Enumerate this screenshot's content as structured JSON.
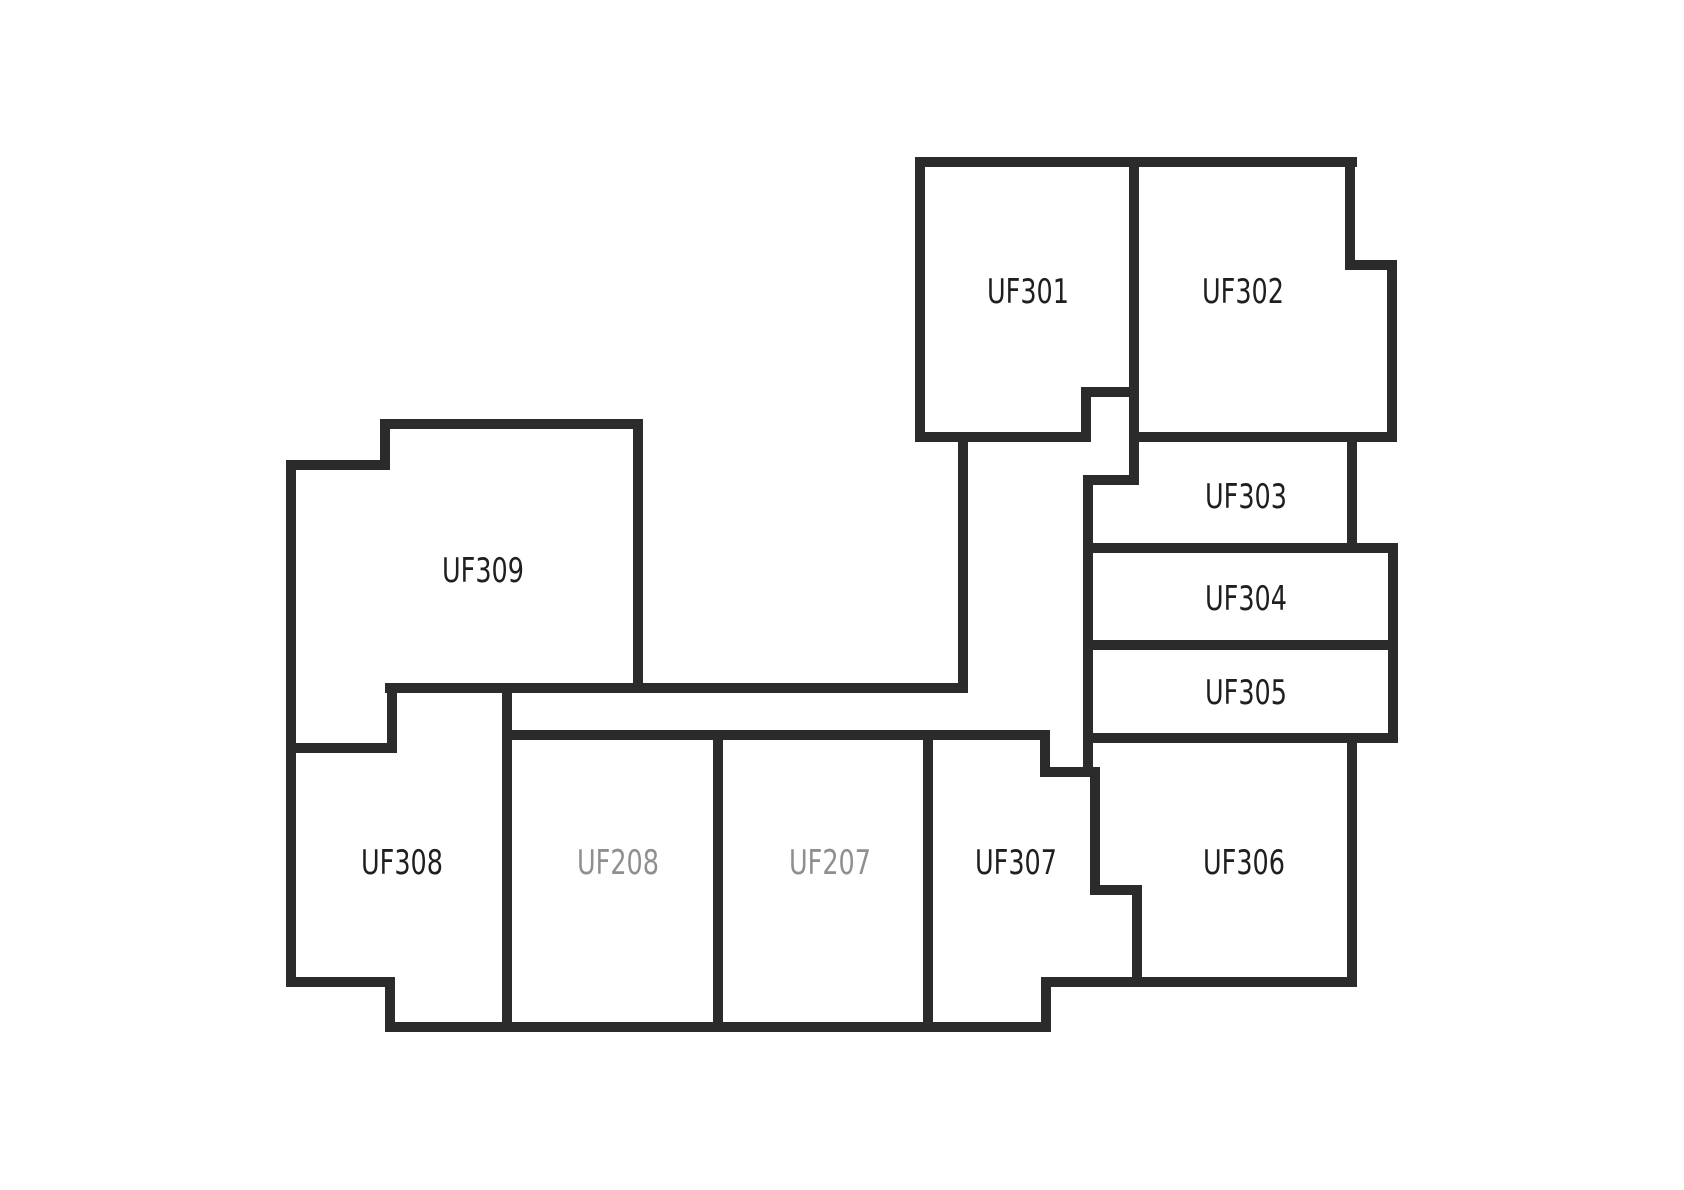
{
  "canvas": {
    "width": 1684,
    "height": 1190,
    "background": "#ffffff"
  },
  "style": {
    "wall_color": "#2b2b2b",
    "wall_thickness": 10,
    "label_color": "#1f1f1f",
    "label_color_muted": "#8f8f8f",
    "label_font_size": 34,
    "label_x_scale": 0.75
  },
  "floorplan": {
    "rooms": [
      {
        "id": "uf301",
        "label": "UF301",
        "muted": false,
        "label_x": 1028,
        "label_y": 291
      },
      {
        "id": "uf302",
        "label": "UF302",
        "muted": false,
        "label_x": 1243,
        "label_y": 291
      },
      {
        "id": "uf303",
        "label": "UF303",
        "muted": false,
        "label_x": 1246,
        "label_y": 496
      },
      {
        "id": "uf304",
        "label": "UF304",
        "muted": false,
        "label_x": 1246,
        "label_y": 598
      },
      {
        "id": "uf305",
        "label": "UF305",
        "muted": false,
        "label_x": 1246,
        "label_y": 692
      },
      {
        "id": "uf306",
        "label": "UF306",
        "muted": false,
        "label_x": 1244,
        "label_y": 862
      },
      {
        "id": "uf307",
        "label": "UF307",
        "muted": false,
        "label_x": 1016,
        "label_y": 862
      },
      {
        "id": "uf207",
        "label": "UF207",
        "muted": true,
        "label_x": 830,
        "label_y": 862
      },
      {
        "id": "uf208",
        "label": "UF208",
        "muted": true,
        "label_x": 618,
        "label_y": 862
      },
      {
        "id": "uf308",
        "label": "UF308",
        "muted": false,
        "label_x": 402,
        "label_y": 862
      },
      {
        "id": "uf309",
        "label": "UF309",
        "muted": false,
        "label_x": 483,
        "label_y": 570
      }
    ],
    "walls": [
      {
        "x1": 920,
        "y1": 162,
        "x2": 1352,
        "y2": 162
      },
      {
        "x1": 920,
        "y1": 162,
        "x2": 920,
        "y2": 437
      },
      {
        "x1": 920,
        "y1": 437,
        "x2": 1086,
        "y2": 437
      },
      {
        "x1": 1086,
        "y1": 392,
        "x2": 1086,
        "y2": 437
      },
      {
        "x1": 1086,
        "y1": 392,
        "x2": 1134,
        "y2": 392
      },
      {
        "x1": 1134,
        "y1": 162,
        "x2": 1134,
        "y2": 480
      },
      {
        "x1": 1350,
        "y1": 162,
        "x2": 1350,
        "y2": 265
      },
      {
        "x1": 1350,
        "y1": 265,
        "x2": 1392,
        "y2": 265
      },
      {
        "x1": 1392,
        "y1": 265,
        "x2": 1392,
        "y2": 437
      },
      {
        "x1": 1134,
        "y1": 437,
        "x2": 1392,
        "y2": 437
      },
      {
        "x1": 1088,
        "y1": 480,
        "x2": 1134,
        "y2": 480
      },
      {
        "x1": 1088,
        "y1": 480,
        "x2": 1088,
        "y2": 772
      },
      {
        "x1": 1352,
        "y1": 437,
        "x2": 1352,
        "y2": 548
      },
      {
        "x1": 1088,
        "y1": 548,
        "x2": 1393,
        "y2": 548
      },
      {
        "x1": 1088,
        "y1": 645,
        "x2": 1393,
        "y2": 645
      },
      {
        "x1": 1393,
        "y1": 548,
        "x2": 1393,
        "y2": 738
      },
      {
        "x1": 1088,
        "y1": 738,
        "x2": 1393,
        "y2": 738
      },
      {
        "x1": 1352,
        "y1": 738,
        "x2": 1352,
        "y2": 982
      },
      {
        "x1": 1046,
        "y1": 982,
        "x2": 1352,
        "y2": 982
      },
      {
        "x1": 1137,
        "y1": 890,
        "x2": 1137,
        "y2": 982
      },
      {
        "x1": 1095,
        "y1": 890,
        "x2": 1137,
        "y2": 890
      },
      {
        "x1": 1095,
        "y1": 772,
        "x2": 1095,
        "y2": 890
      },
      {
        "x1": 1045,
        "y1": 772,
        "x2": 1095,
        "y2": 772
      },
      {
        "x1": 1045,
        "y1": 735,
        "x2": 1045,
        "y2": 772
      },
      {
        "x1": 510,
        "y1": 735,
        "x2": 1045,
        "y2": 735
      },
      {
        "x1": 1046,
        "y1": 982,
        "x2": 1046,
        "y2": 1027
      },
      {
        "x1": 390,
        "y1": 1027,
        "x2": 1046,
        "y2": 1027
      },
      {
        "x1": 928,
        "y1": 735,
        "x2": 928,
        "y2": 1027
      },
      {
        "x1": 718,
        "y1": 735,
        "x2": 718,
        "y2": 1027
      },
      {
        "x1": 507,
        "y1": 688,
        "x2": 507,
        "y2": 1027
      },
      {
        "x1": 390,
        "y1": 688,
        "x2": 963,
        "y2": 688
      },
      {
        "x1": 963,
        "y1": 437,
        "x2": 963,
        "y2": 688
      },
      {
        "x1": 638,
        "y1": 424,
        "x2": 638,
        "y2": 688
      },
      {
        "x1": 385,
        "y1": 424,
        "x2": 638,
        "y2": 424
      },
      {
        "x1": 385,
        "y1": 424,
        "x2": 385,
        "y2": 465
      },
      {
        "x1": 291,
        "y1": 465,
        "x2": 385,
        "y2": 465
      },
      {
        "x1": 291,
        "y1": 465,
        "x2": 291,
        "y2": 982
      },
      {
        "x1": 291,
        "y1": 748,
        "x2": 392,
        "y2": 748
      },
      {
        "x1": 392,
        "y1": 688,
        "x2": 392,
        "y2": 748
      },
      {
        "x1": 291,
        "y1": 982,
        "x2": 390,
        "y2": 982
      },
      {
        "x1": 390,
        "y1": 982,
        "x2": 390,
        "y2": 1027
      }
    ]
  }
}
